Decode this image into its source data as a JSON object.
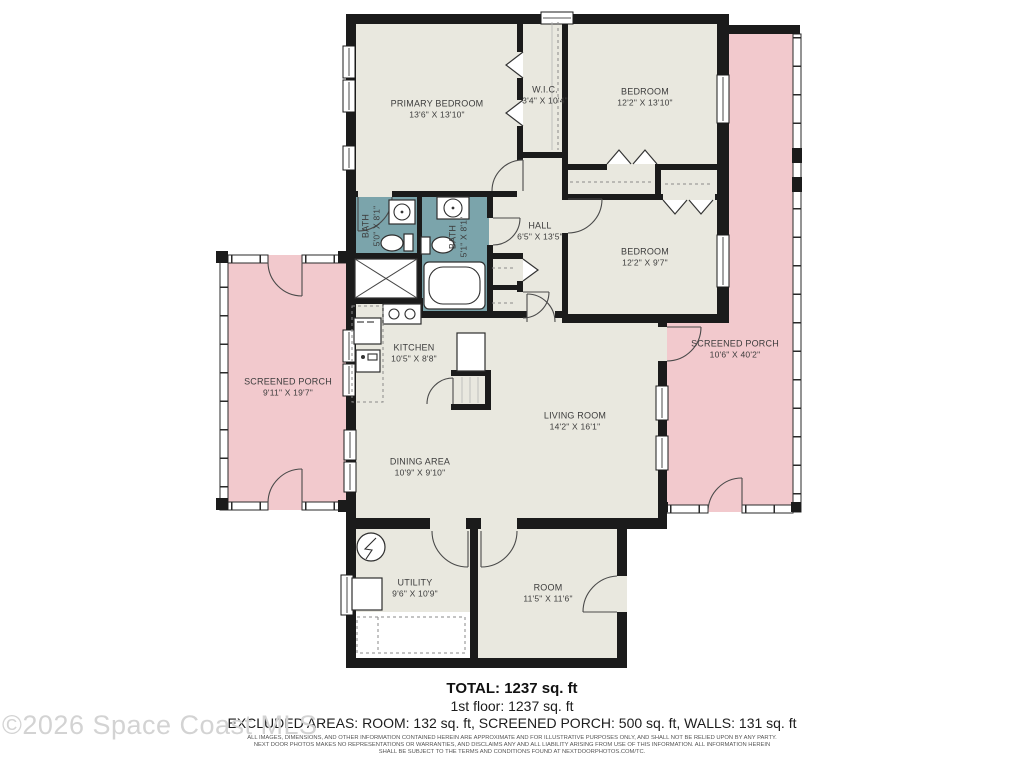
{
  "colors": {
    "wall": "#1b1b1b",
    "room-fill": "#e9e8df",
    "porch-fill": "#f2c9cd",
    "bath-fill": "#7ba4ab",
    "label-text": "#3c3c3c",
    "fine-print": "#555555",
    "watermark": "#d3d3d3"
  },
  "rooms": [
    {
      "id": "primary-bedroom",
      "name": "PRIMARY BEDROOM",
      "dims": "13'6\" X 13'10\""
    },
    {
      "id": "wic",
      "name": "W.I.C.",
      "dims": "3'4\" X 10'4\""
    },
    {
      "id": "bedroom-top",
      "name": "BEDROOM",
      "dims": "12'2\" X 13'10\""
    },
    {
      "id": "bath-left",
      "name": "BATH",
      "dims": "5'0\" X 8'1\""
    },
    {
      "id": "bath-right",
      "name": "BATH",
      "dims": "5'1\" X 8'1\""
    },
    {
      "id": "hall",
      "name": "HALL",
      "dims": "6'5\" X 13'5\""
    },
    {
      "id": "bedroom-middle",
      "name": "BEDROOM",
      "dims": "12'2\" X 9'7\""
    },
    {
      "id": "kitchen",
      "name": "KITCHEN",
      "dims": "10'5\" X 8'8\""
    },
    {
      "id": "screened-porch-left",
      "name": "SCREENED PORCH",
      "dims": "9'11\" X 19'7\""
    },
    {
      "id": "screened-porch-right",
      "name": "SCREENED PORCH",
      "dims": "10'6\" X 40'2\""
    },
    {
      "id": "living-room",
      "name": "LIVING ROOM",
      "dims": "14'2\" X 16'1\""
    },
    {
      "id": "dining-area",
      "name": "DINING AREA",
      "dims": "10'9\" X 9'10\""
    },
    {
      "id": "utility",
      "name": "UTILITY",
      "dims": "9'6\" X 10'9\""
    },
    {
      "id": "room",
      "name": "ROOM",
      "dims": "11'5\" X 11'6\""
    }
  ],
  "summary": {
    "total": "TOTAL: 1237 sq. ft",
    "first_floor": "1st floor: 1237 sq. ft",
    "excluded": "EXCLUDED AREAS: ROOM: 132 sq. ft, SCREENED PORCH: 500 sq. ft, WALLS: 131 sq. ft"
  },
  "disclaimer": {
    "line1": "ALL IMAGES, DIMENSIONS, AND OTHER INFORMATION CONTAINED HEREIN ARE APPROXIMATE AND FOR ILLUSTRATIVE PURPOSES ONLY, AND SHALL NOT BE RELIED UPON BY ANY PARTY.",
    "line2": "NEXT DOOR PHOTOS MAKES NO REPRESENTATIONS OR WARRANTIES, AND DISCLAIMS ANY AND ALL LIABILITY ARISING FROM USE OF THIS INFORMATION. ALL INFORMATION HEREIN",
    "line3": "SHALL BE SUBJECT TO THE TERMS AND CONDITIONS FOUND AT NEXTDOORPHOTOS.COM/TC."
  },
  "watermark": "©2026 Space Coast MLS"
}
